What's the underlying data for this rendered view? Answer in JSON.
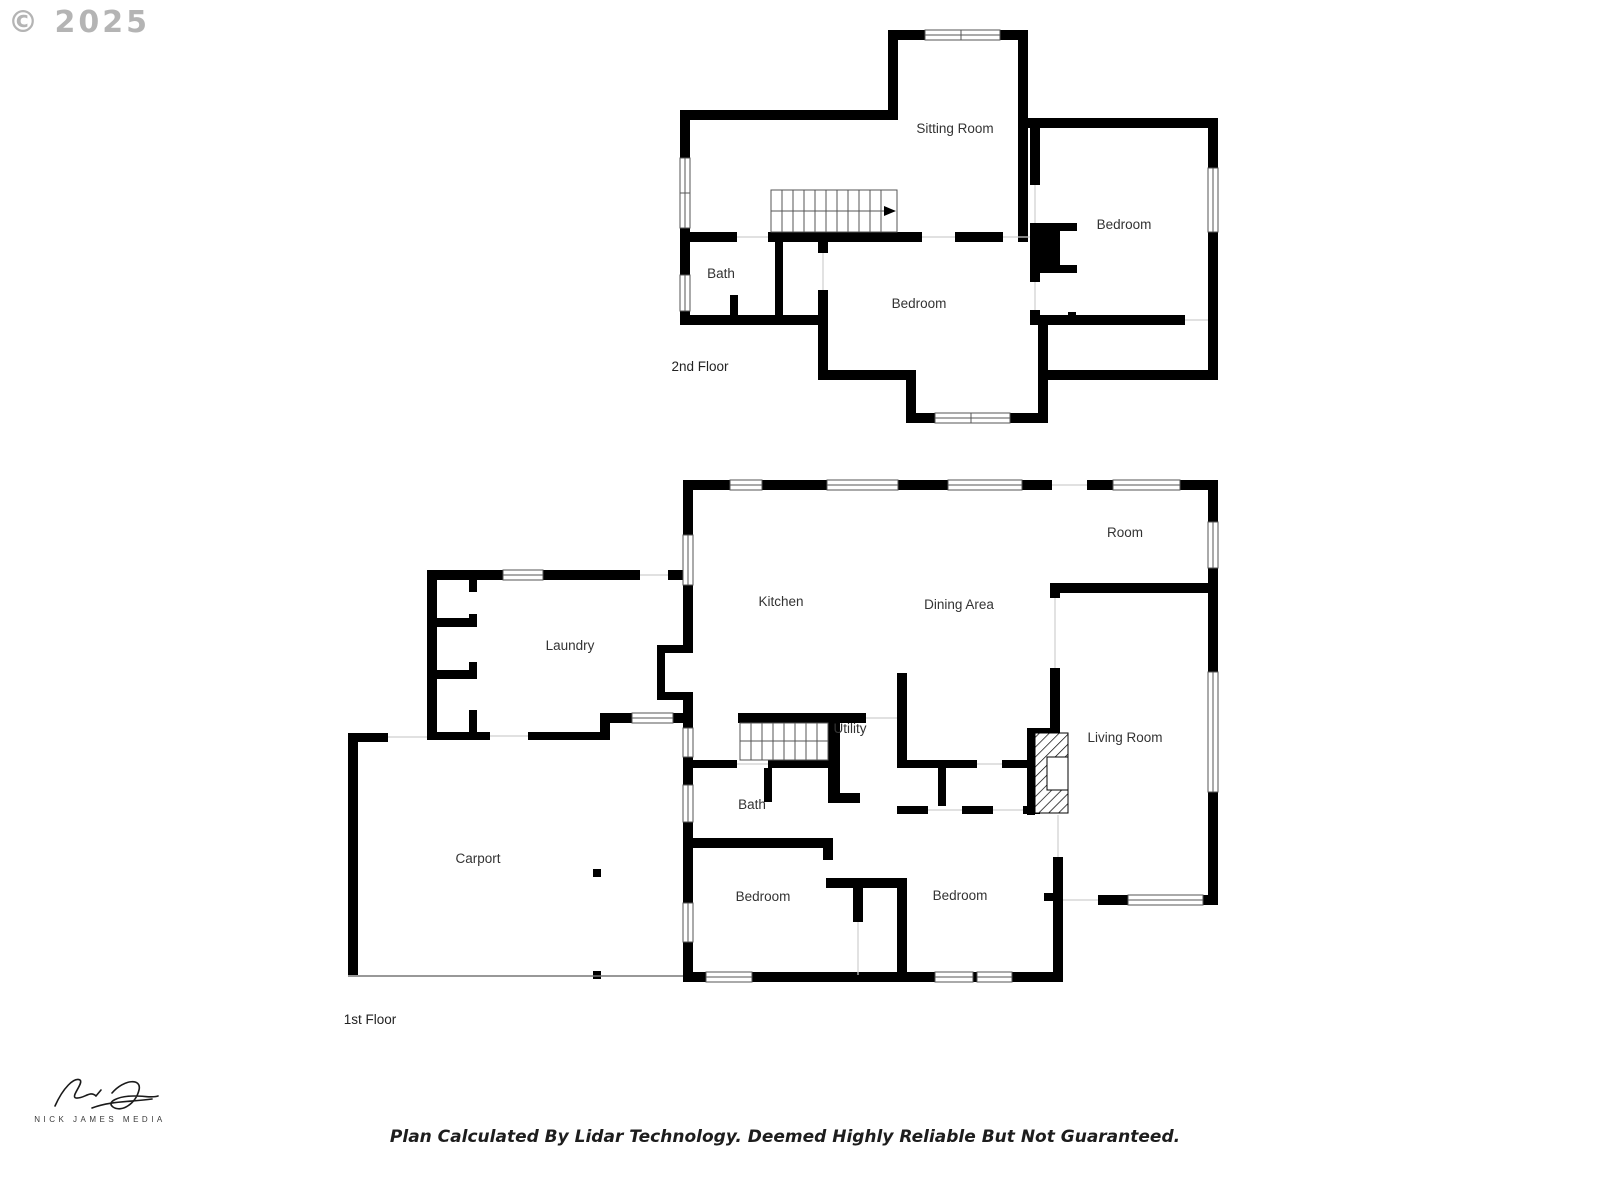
{
  "copyright": {
    "text": "© 2025"
  },
  "floor2": {
    "label": "2nd Floor",
    "rooms": {
      "sitting": "Sitting Room",
      "bedroom_right": "Bedroom",
      "bath": "Bath",
      "bedroom_center": "Bedroom"
    }
  },
  "floor1": {
    "label": "1st Floor",
    "rooms": {
      "room": "Room",
      "kitchen": "Kitchen",
      "dining": "Dining Area",
      "laundry": "Laundry",
      "utility": "Utility",
      "living": "Living Room",
      "bath": "Bath",
      "carport": "Carport",
      "bedroom_left": "Bedroom",
      "bedroom_right": "Bedroom"
    }
  },
  "signature": {
    "brand": "NICK JAMES MEDIA"
  },
  "footer": {
    "text": "Plan Calculated By Lidar Technology. Deemed Highly Reliable But Not Guaranteed."
  },
  "colors": {
    "wall": "#000000",
    "window_frame": "#555555",
    "label": "#333333",
    "copyright_gray": "#9b9b9b"
  }
}
